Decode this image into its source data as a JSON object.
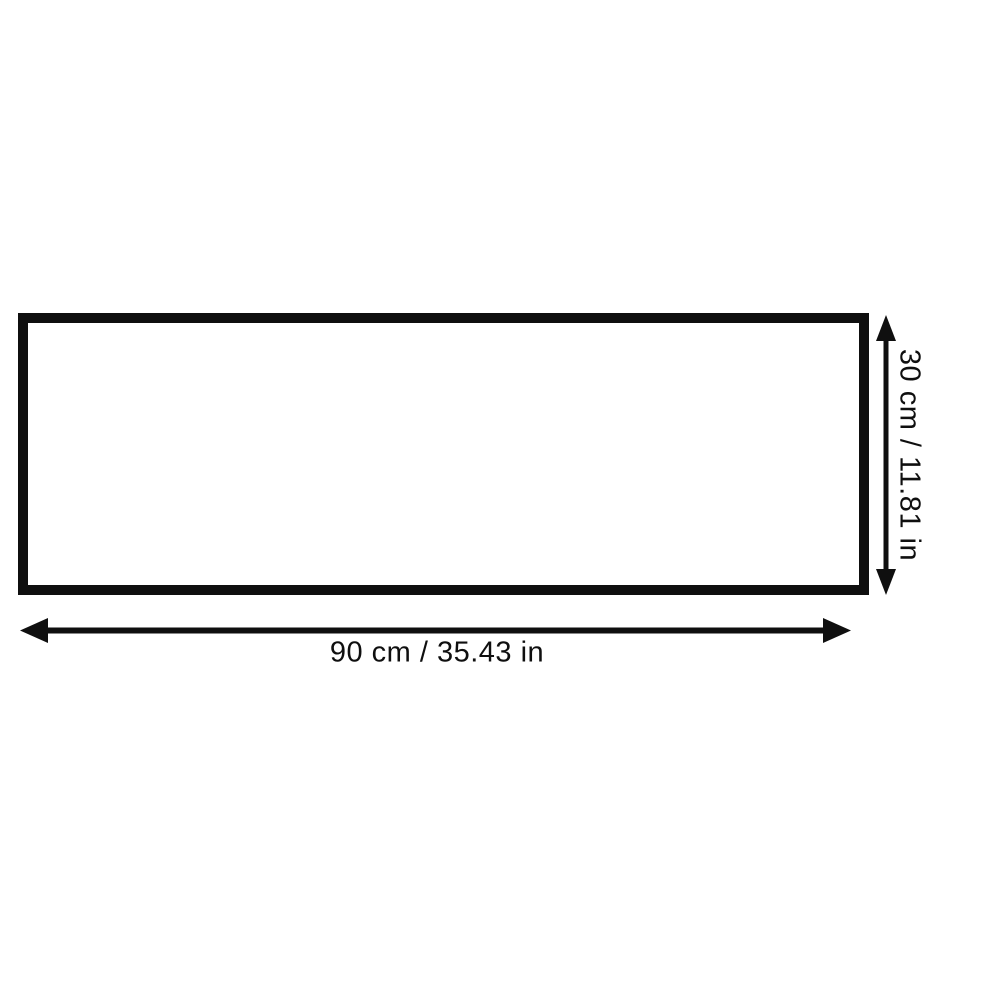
{
  "diagram": {
    "type": "dimension-diagram",
    "shape": "rectangle",
    "width_label": "90 cm / 35.43 in",
    "height_label": "30 cm / 11.81 in",
    "width_cm": 90,
    "width_in": 35.43,
    "height_cm": 30,
    "height_in": 11.81,
    "colors": {
      "line": "#0f0f0f",
      "background": "#ffffff",
      "box_fill": "#ffffff"
    }
  }
}
